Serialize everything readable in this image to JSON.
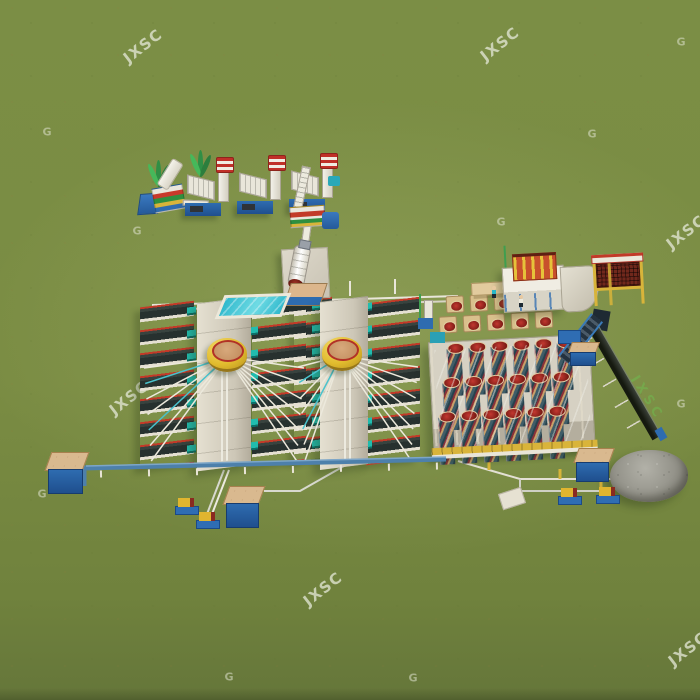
{
  "scene": {
    "description": "Aerial isometric 3D rendering of a JXSC mineral processing (gravity separation) plant standing on mottled green grassland",
    "style": "CGI product render",
    "ground": "green grass"
  },
  "watermarks": {
    "logo_text": "JXSC",
    "letter_mark": "G",
    "logo_color": "#e2e5d4",
    "green_logo_color": "#6ebe50"
  },
  "plant": {
    "crushing_line": {
      "label": "feed hopper, vibrating feeder and three crusher/elevator towers with screens",
      "tower_count": 3,
      "base_color": "#2e6cb0",
      "stripe_color": "#c03028"
    },
    "ball_mill": {
      "label": "ball mill on concrete foundation",
      "shell_color": "#ffffff",
      "end_cap_color": "#8a2a20"
    },
    "water_pool": {
      "label": "water pool",
      "water_color": "#3ec8d8"
    },
    "shaking_table_area": {
      "label": "two banks of shaking tables fed by rotary slurry distributors",
      "groups": 2,
      "columns_per_group": 2,
      "tables_per_column": 7,
      "deck_color": "#2e3937",
      "rim_color": "#c23a28",
      "motor_color": "#21bcae",
      "distributor_color": "#e2bc2e"
    },
    "spiral_chute_area": {
      "label": "double-deck spiral chute separator array",
      "rows": 3,
      "columns": 6,
      "head_rows": 2,
      "heads_per_row": 5,
      "stripe_colors": [
        "#3f5d68",
        "#8a3138",
        "#c9a06a"
      ],
      "launder_color": "#d9b43a"
    },
    "screen_building": {
      "label": "elevated screening platform, red vibrating screen and mesh hopper on yellow frame"
    },
    "tailings": {
      "label": "inclined tailings belt conveyor and grey stockpile",
      "belt_color": "#15190f",
      "pile_color": "#8e8d84"
    },
    "piping": {
      "label": "slurry pipelines, slurry pumps and sand tanks",
      "pipe_color": "#4d80ab",
      "tank_top_color": "#d9b98f"
    },
    "workers": 2,
    "trees": 2
  }
}
